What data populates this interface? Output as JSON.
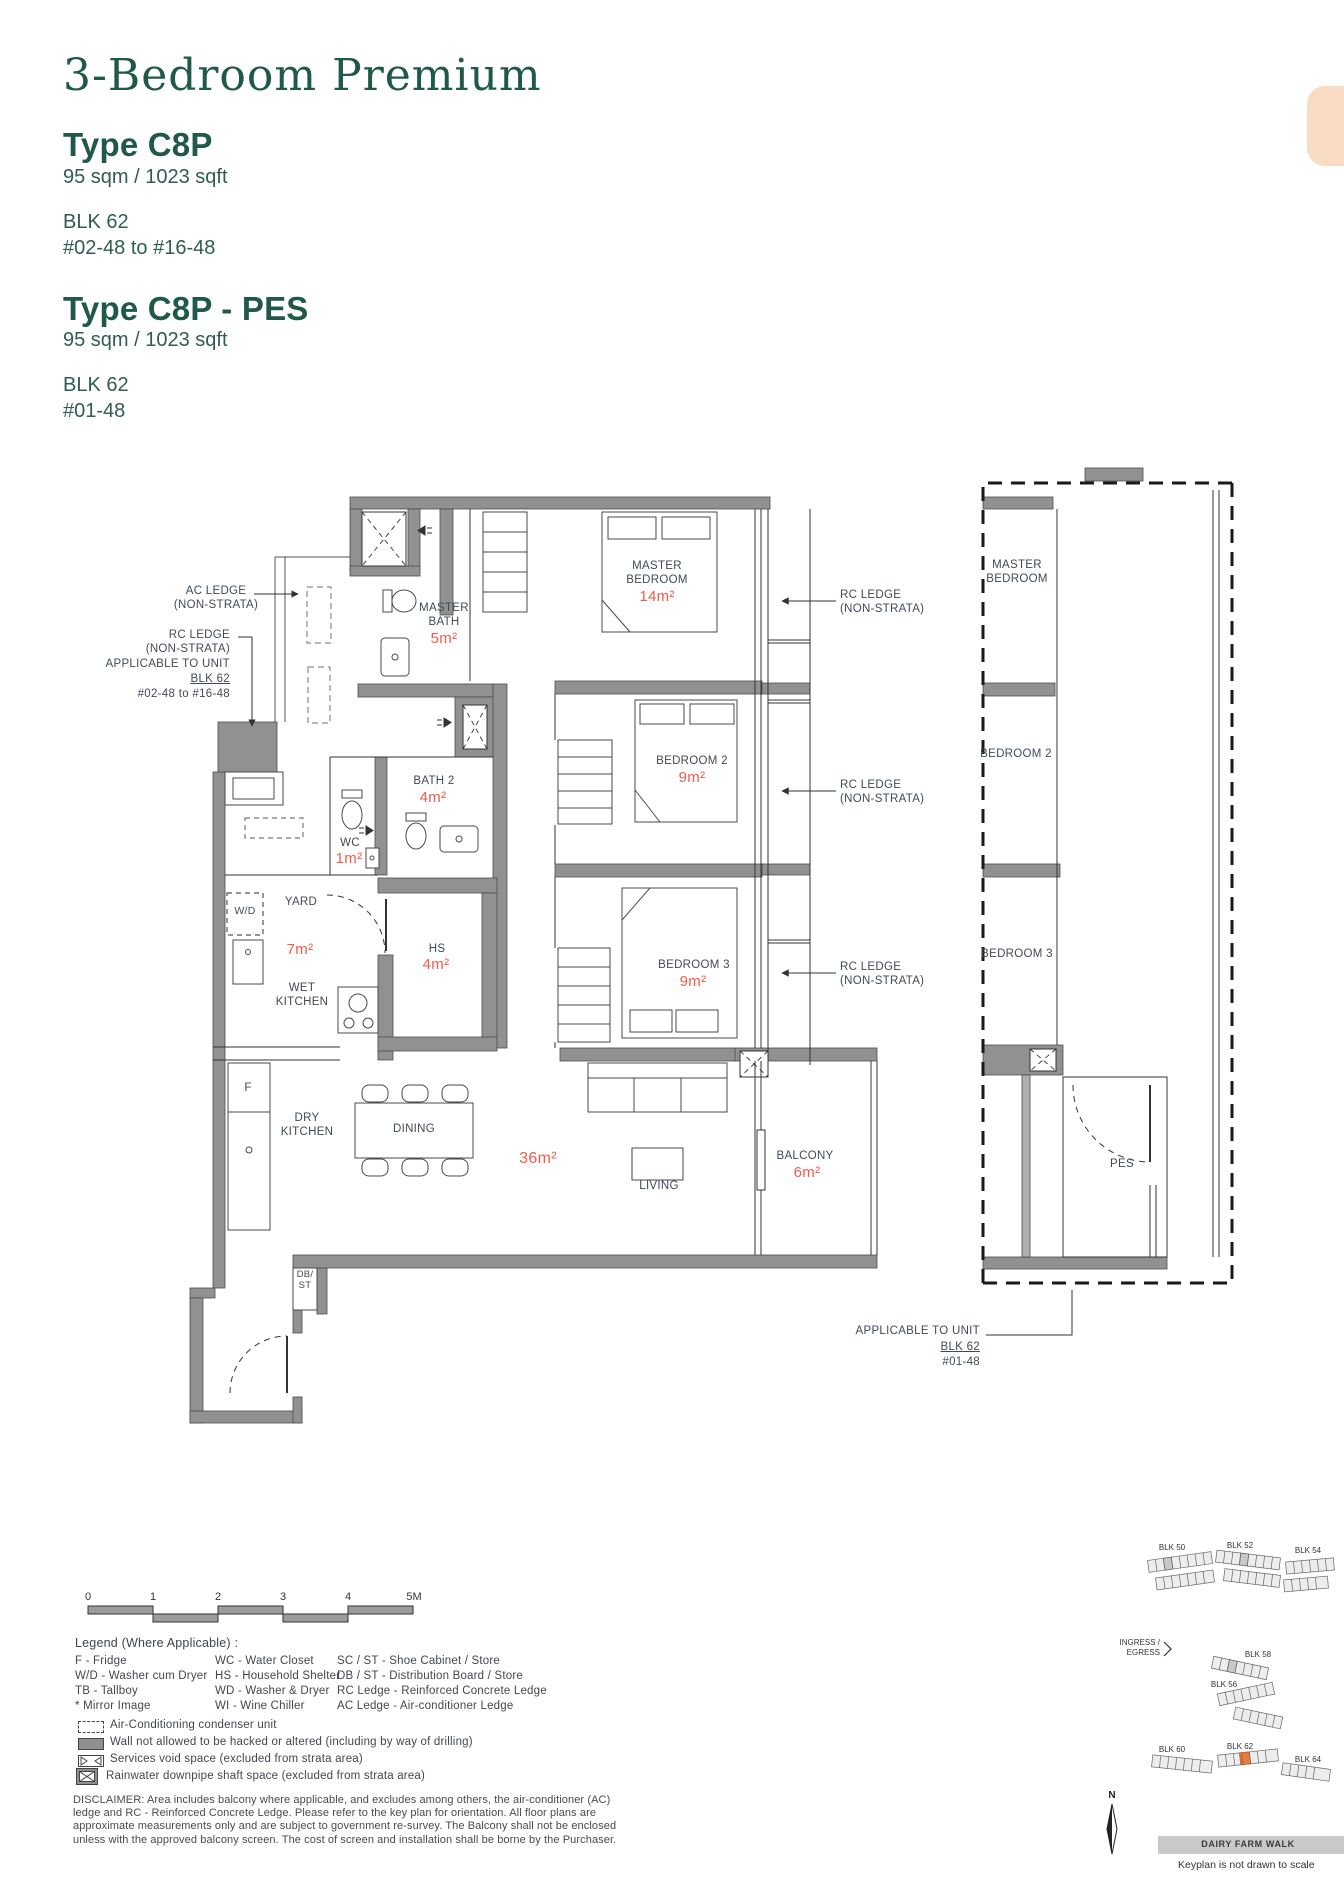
{
  "header": {
    "title": "3-Bedroom Premium",
    "type1": {
      "name": "Type C8P",
      "area": "95 sqm / 1023 sqft",
      "block": "BLK 62",
      "units": "#02-48 to #16-48"
    },
    "type2": {
      "name": "Type C8P - PES",
      "area": "95 sqm / 1023 sqft",
      "block": "BLK 62",
      "units": "#01-48"
    }
  },
  "plan": {
    "labels": {
      "ac_ledge_line1": "AC LEDGE",
      "ac_ledge_line2": "(NON-STRATA)",
      "rc_left_line1": "RC LEDGE",
      "rc_left_line2": "(NON-STRATA)",
      "rc_left_line3": "APPLICABLE TO UNIT",
      "rc_left_line4": "BLK 62",
      "rc_left_line5": "#02-48 to #16-48",
      "rc_right_line1": "RC LEDGE",
      "rc_right_line2": "(NON-STRATA)"
    },
    "rooms": {
      "master_bath": {
        "name": "MASTER BATH",
        "area": "5m²"
      },
      "master_bedroom": {
        "name": "MASTER BEDROOM",
        "area": "14m²"
      },
      "bath2": {
        "name": "BATH 2",
        "area": "4m²"
      },
      "bedroom2": {
        "name": "BEDROOM 2",
        "area": "9m²"
      },
      "wc": {
        "name": "WC",
        "area": "1m²"
      },
      "yard": {
        "name": "YARD",
        "area": "7m²"
      },
      "hs": {
        "name": "HS",
        "area": "4m²"
      },
      "wet_kitchen": {
        "name": "WET KITCHEN"
      },
      "bedroom3": {
        "name": "BEDROOM 3",
        "area": "9m²"
      },
      "dry_kitchen": {
        "name": "DRY KITCHEN"
      },
      "dining": {
        "name": "DINING"
      },
      "living": {
        "name": "LIVING",
        "area": "36m²"
      },
      "balcony": {
        "name": "BALCONY",
        "area": "6m²"
      },
      "fridge": "F",
      "washer_dryer": "W/D",
      "db_st": "DB/ ST"
    },
    "pes_plan": {
      "master_bedroom": "MASTER BEDROOM",
      "bedroom2": "BEDROOM 2",
      "bedroom3": "BEDROOM 3",
      "pes": "PES",
      "applicable_line1": "APPLICABLE TO UNIT",
      "applicable_line2": "BLK 62",
      "applicable_line3": "#01-48"
    }
  },
  "scalebar": {
    "ticks": [
      "0",
      "1",
      "2",
      "3",
      "4",
      "5M"
    ]
  },
  "legend": {
    "heading": "Legend (Where Applicable) :",
    "col1": [
      "F - Fridge",
      "W/D - Washer cum Dryer",
      "TB - Tallboy",
      "* Mirror Image"
    ],
    "col2": [
      "WC - Water Closet",
      "HS - Household Shelter",
      "WD - Washer & Dryer",
      "WI - Wine Chiller"
    ],
    "col3": [
      "SC / ST - Shoe Cabinet / Store",
      "DB / ST - Distribution Board / Store",
      "RC Ledge - Reinforced Concrete Ledge",
      "AC Ledge - Air-conditioner Ledge"
    ],
    "symbols": [
      "Air-Conditioning condenser unit",
      "Wall not allowed to be hacked or altered (including by way of drilling)",
      "Services void space (excluded from strata area)",
      "Rainwater downpipe shaft space (excluded from strata area)"
    ]
  },
  "disclaimer": "DISCLAIMER: Area includes balcony where applicable, and excludes among others, the air-conditioner (AC) ledge and RC - Reinforced Concrete Ledge. Please refer to the key plan for orientation. All floor plans are approximate measurements only and are subject to government re-survey. The Balcony shall not be enclosed unless with the approved balcony screen. The cost of screen and installation shall be borne by the Purchaser.",
  "keyplan": {
    "blk50": "BLK 50",
    "blk52": "BLK 52",
    "blk54": "BLK 54",
    "blk56": "BLK 56",
    "blk58": "BLK 58",
    "blk60": "BLK 60",
    "blk62": "BLK 62",
    "blk64": "BLK 64",
    "ingress1": "INGRESS /",
    "ingress2": "EGRESS",
    "road": "DAIRY FARM WALK",
    "note": "Keyplan is not drawn to scale",
    "north": "N"
  },
  "colors": {
    "heading_green": "#20584a",
    "body_green": "#2f5d4e",
    "label_slate": "#3f4a59",
    "area_red": "#f15b49",
    "wall_gray": "#919191",
    "highlight_orange": "#e87a3e",
    "tab_peach": "#f8dcc3"
  }
}
